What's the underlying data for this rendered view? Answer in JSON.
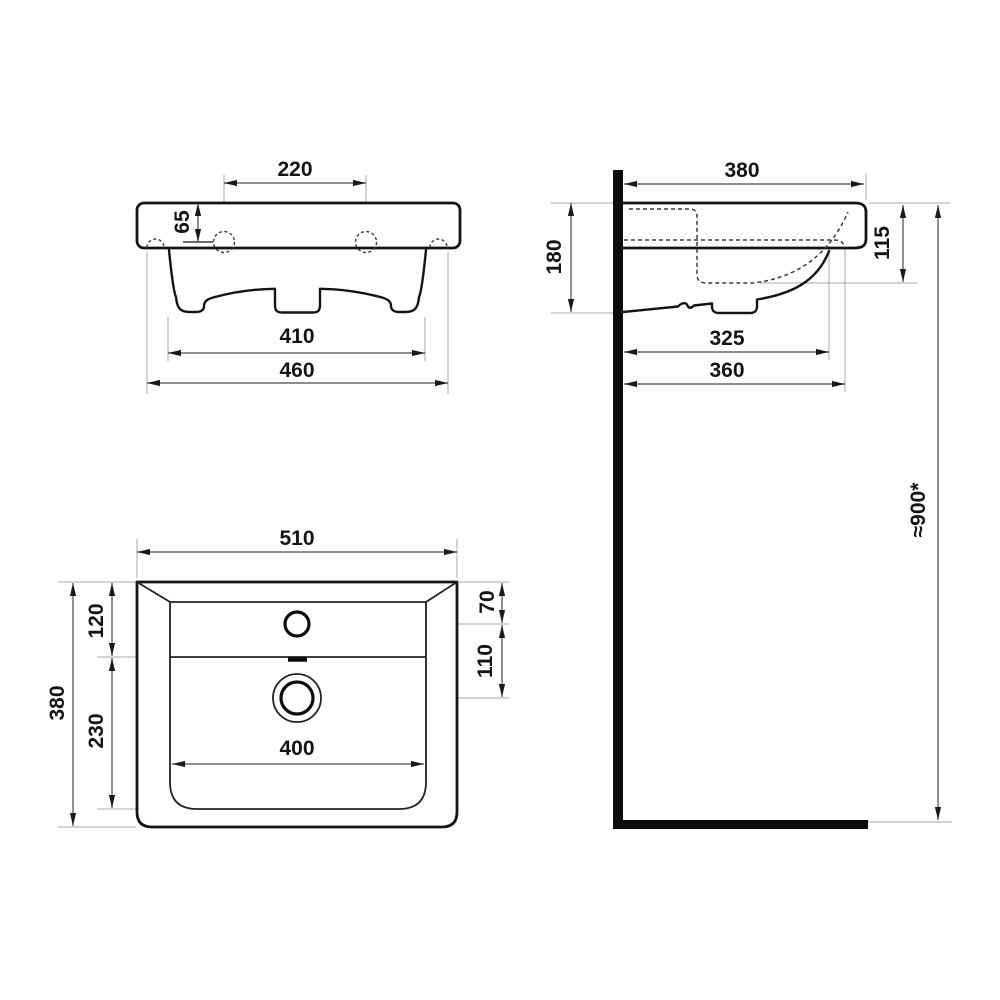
{
  "drawing": {
    "kind": "technical-dimension-drawing",
    "subject": "wall-mounted washbasin, three orthographic views, dimensions in mm",
    "colors": {
      "line": "#141414",
      "dimension": "#4a4a4a",
      "extension": "#a9a9a9",
      "background": "#ffffff"
    },
    "views": {
      "front": {
        "name": "front view",
        "dims": {
          "hole_spacing": "220",
          "deck_height": "65",
          "body_width": "410",
          "overall_width": "460"
        }
      },
      "side": {
        "name": "side view",
        "dims": {
          "overall_depth": "380",
          "height_at_wall": "180",
          "rim_to_basin_bottom": "115",
          "basin_depth": "325",
          "body_depth": "360",
          "mounting_height": "≈900*"
        }
      },
      "plan": {
        "name": "plan view",
        "dims": {
          "overall_width": "510",
          "overall_depth": "380",
          "deck_depth": "120",
          "basin_rear_depth": "230",
          "faucet_from_rear": "70",
          "faucet_to_drain": "110",
          "basin_width": "400"
        }
      }
    }
  }
}
